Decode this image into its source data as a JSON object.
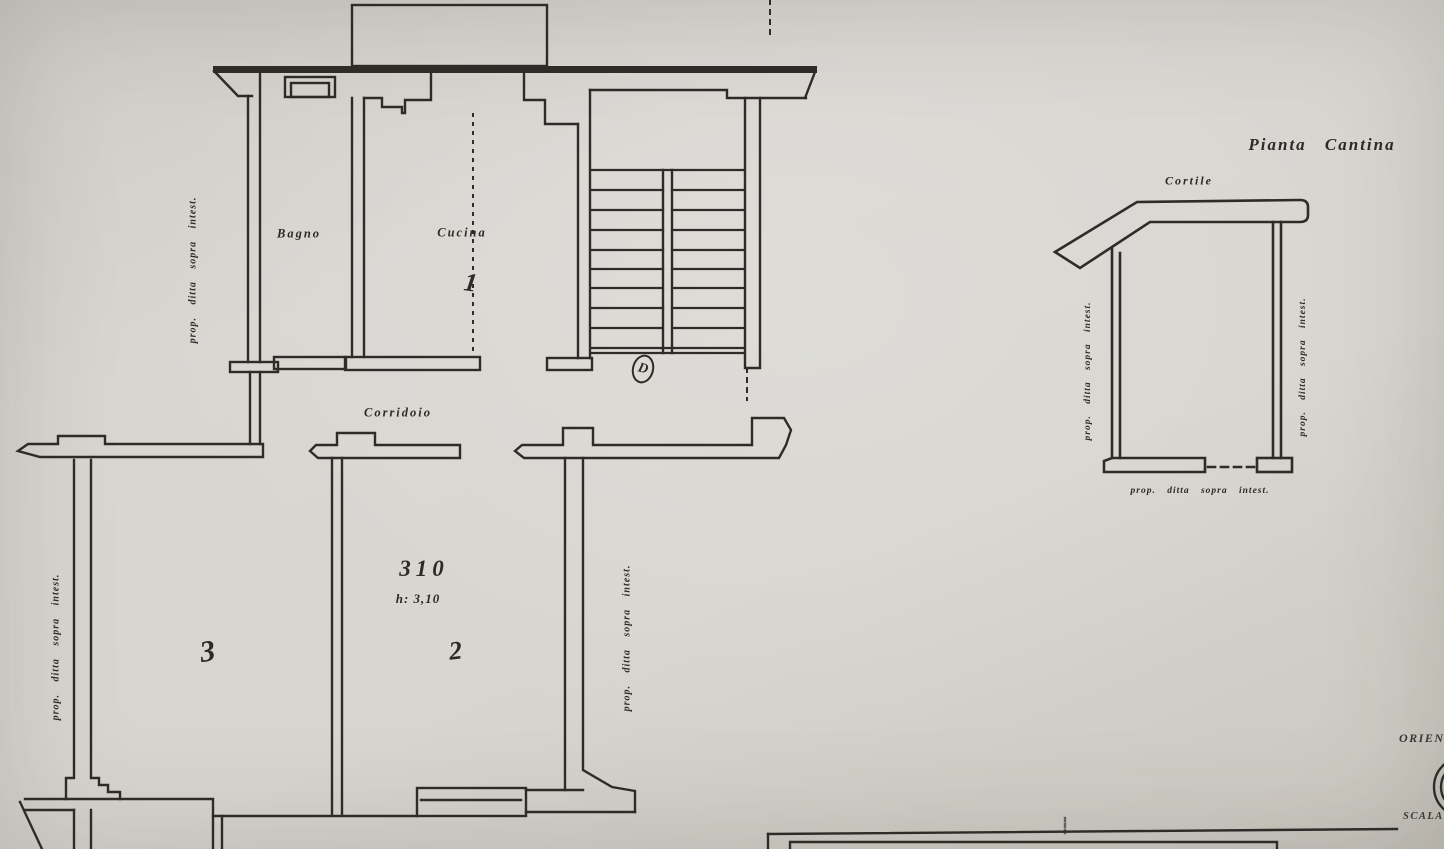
{
  "drawing": {
    "background": "#d6d3ce",
    "ink": "#2e2c28",
    "main_plan": {
      "bagno_label": "Bagno",
      "cucina_label": "Cucina",
      "cucina_number": "1",
      "corridoio_label": "Corridoio",
      "room2_area": "310",
      "room2_height": "h: 3,10",
      "room2_number": "2",
      "room3_number": "3",
      "stair_letter": "D",
      "boundary_label_top_left": "prop. ditta sopra intest.",
      "boundary_label_bottom_left": "prop. ditta sopra intest.",
      "boundary_label_right": "prop. ditta sopra intest."
    },
    "cantina_plan": {
      "title": "Pianta Cantina",
      "cortile_label": "Cortile",
      "boundary_label_left": "prop. ditta sopra intest.",
      "boundary_label_right": "prop. ditta sopra intest.",
      "boundary_label_bottom": "prop. ditta sopra intest."
    },
    "corner_block": {
      "orientation_label": "ORIEN",
      "scale_label": "SCALA"
    }
  }
}
